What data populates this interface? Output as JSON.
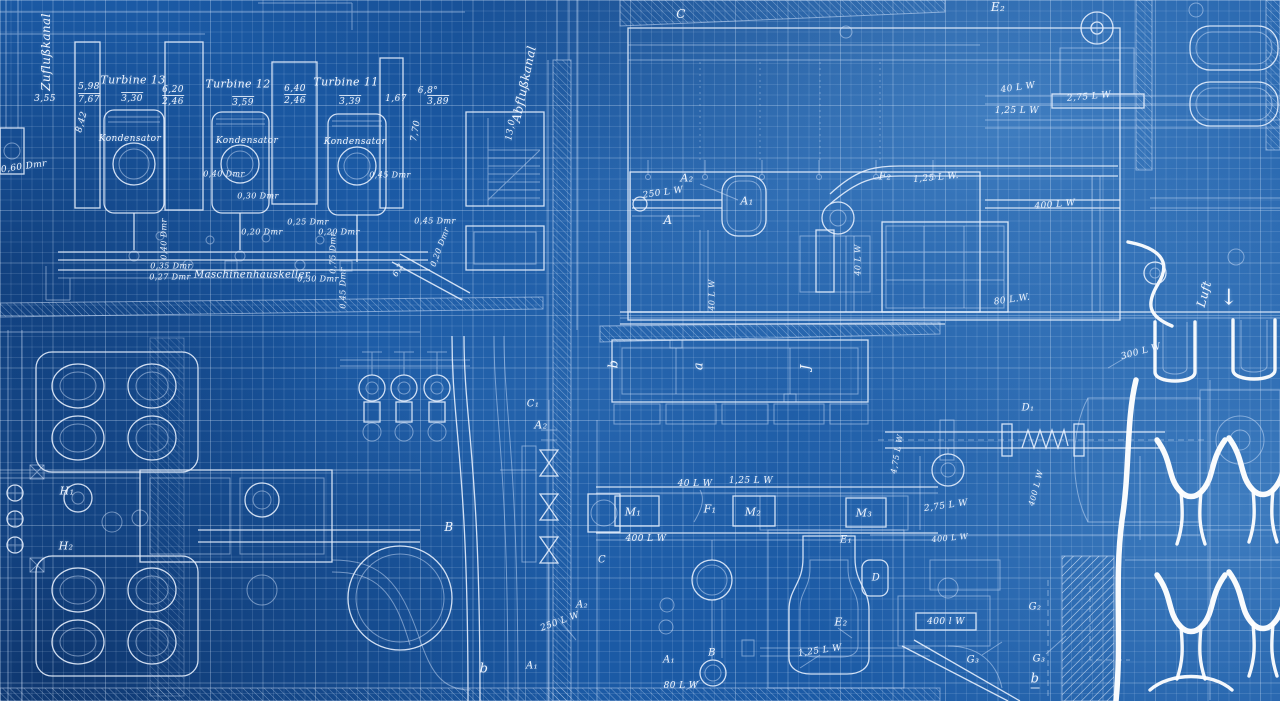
{
  "colors": {
    "paper": "#1b5aa5",
    "line": "#eaf2ff",
    "grid": "rgba(214,232,255,0.15)",
    "bright": "#ffffff"
  },
  "labels": [
    {
      "t": "Zuflußkanal",
      "x": 46,
      "y": 52,
      "r": -90,
      "s": 12
    },
    {
      "t": "Abflußkanal",
      "x": 524,
      "y": 84,
      "r": -78,
      "s": 12
    },
    {
      "t": "3,55",
      "x": 45,
      "y": 99,
      "s": 9
    },
    {
      "t": "5,98",
      "x": 89,
      "y": 87,
      "s": 9
    },
    {
      "t": "7,67",
      "x": 89,
      "y": 99,
      "s": 9,
      "o": 1
    },
    {
      "t": "8,42",
      "x": 82,
      "y": 122,
      "r": -75,
      "s": 9
    },
    {
      "t": "Turbine 13",
      "x": 133,
      "y": 80,
      "s": 11
    },
    {
      "t": "3,30",
      "x": 132,
      "y": 98,
      "s": 9,
      "o": 1
    },
    {
      "t": "Kondensator",
      "x": 130,
      "y": 139,
      "s": 9
    },
    {
      "t": "6,20",
      "x": 173,
      "y": 90,
      "s": 9
    },
    {
      "t": "2,46",
      "x": 173,
      "y": 101,
      "s": 9,
      "o": 1
    },
    {
      "t": "Turbine 12",
      "x": 238,
      "y": 84,
      "s": 11
    },
    {
      "t": "3,59",
      "x": 243,
      "y": 102,
      "s": 9,
      "o": 1
    },
    {
      "t": "Kondensator",
      "x": 247,
      "y": 141,
      "s": 9
    },
    {
      "t": "6,40",
      "x": 295,
      "y": 89,
      "s": 9
    },
    {
      "t": "2,46",
      "x": 295,
      "y": 100,
      "s": 9,
      "o": 1
    },
    {
      "t": "Turbine 11",
      "x": 346,
      "y": 82,
      "s": 11
    },
    {
      "t": "3,39",
      "x": 350,
      "y": 101,
      "s": 9,
      "o": 1
    },
    {
      "t": "Kondensator",
      "x": 355,
      "y": 142,
      "s": 9
    },
    {
      "t": "1,67",
      "x": 396,
      "y": 99,
      "s": 9
    },
    {
      "t": "6,8°",
      "x": 428,
      "y": 91,
      "s": 9
    },
    {
      "t": "3,89",
      "x": 438,
      "y": 101,
      "s": 9,
      "o": 1
    },
    {
      "t": "7,70",
      "x": 416,
      "y": 131,
      "r": -80,
      "s": 9
    },
    {
      "t": "13,0",
      "x": 511,
      "y": 130,
      "r": -80,
      "s": 9
    },
    {
      "t": "0,60 Dmr",
      "x": 24,
      "y": 167,
      "r": -8,
      "s": 9
    },
    {
      "t": "0,40 Dmr",
      "x": 164,
      "y": 239,
      "r": -90,
      "s": 8
    },
    {
      "t": "0,40 Dmr",
      "x": 224,
      "y": 174,
      "s": 8
    },
    {
      "t": "0,45 Dmr",
      "x": 390,
      "y": 175,
      "s": 8
    },
    {
      "t": "0,30 Dmr",
      "x": 258,
      "y": 196,
      "s": 8
    },
    {
      "t": "0,20 Dmr",
      "x": 262,
      "y": 232,
      "s": 8
    },
    {
      "t": "0,25 Dmr",
      "x": 308,
      "y": 222,
      "s": 8
    },
    {
      "t": "0,20 Dmr",
      "x": 339,
      "y": 232,
      "s": 8
    },
    {
      "t": "0,45 Dmr",
      "x": 435,
      "y": 221,
      "s": 8
    },
    {
      "t": "0,20 Dmr",
      "x": 440,
      "y": 247,
      "r": -70,
      "s": 8
    },
    {
      "t": "0,75 Dmr",
      "x": 333,
      "y": 253,
      "r": -90,
      "s": 8
    },
    {
      "t": "0,45 Dmr",
      "x": 343,
      "y": 288,
      "r": -90,
      "s": 8
    },
    {
      "t": "0,35 Dmr",
      "x": 171,
      "y": 266,
      "s": 8
    },
    {
      "t": "0,27 Dmr",
      "x": 170,
      "y": 277,
      "s": 8
    },
    {
      "t": "Maschinenhauskeller",
      "x": 252,
      "y": 275,
      "s": 10
    },
    {
      "t": "0,30 Dmr",
      "x": 318,
      "y": 279,
      "s": 8
    },
    {
      "t": "6,2",
      "x": 398,
      "y": 270,
      "r": -60,
      "s": 8
    },
    {
      "t": "C",
      "x": 681,
      "y": 14,
      "s": 12
    },
    {
      "t": "E₂",
      "x": 998,
      "y": 7,
      "s": 12
    },
    {
      "t": "A₂",
      "x": 687,
      "y": 178,
      "s": 11
    },
    {
      "t": "250 L W",
      "x": 663,
      "y": 193,
      "r": -8,
      "s": 9
    },
    {
      "t": "A",
      "x": 668,
      "y": 220,
      "s": 12
    },
    {
      "t": "A₁",
      "x": 747,
      "y": 201,
      "s": 11
    },
    {
      "t": "F₂",
      "x": 885,
      "y": 176,
      "s": 11
    },
    {
      "t": "1,25 L W.",
      "x": 936,
      "y": 178,
      "r": -5,
      "s": 9
    },
    {
      "t": "40 L W",
      "x": 858,
      "y": 260,
      "r": -90,
      "s": 8
    },
    {
      "t": "40 L W",
      "x": 712,
      "y": 295,
      "r": -90,
      "s": 8
    },
    {
      "t": "40 L W",
      "x": 1018,
      "y": 88,
      "r": -8,
      "s": 9
    },
    {
      "t": "2,75 L W",
      "x": 1089,
      "y": 97,
      "r": -5,
      "s": 9
    },
    {
      "t": "1,25 L W",
      "x": 1017,
      "y": 111,
      "s": 9
    },
    {
      "t": "400 L W",
      "x": 1055,
      "y": 205,
      "r": -5,
      "s": 9
    },
    {
      "t": "80 L.W.",
      "x": 1012,
      "y": 300,
      "r": -8,
      "s": 9
    },
    {
      "t": "Luft",
      "x": 1204,
      "y": 294,
      "r": -75,
      "s": 12
    },
    {
      "t": "↓",
      "x": 1229,
      "y": 298,
      "s": 22,
      "n": "airflow-arrow-icon"
    },
    {
      "t": "300 L W",
      "x": 1141,
      "y": 352,
      "r": -15,
      "s": 9
    },
    {
      "t": "b",
      "x": 614,
      "y": 364,
      "r": -90,
      "s": 13
    },
    {
      "t": "a",
      "x": 699,
      "y": 366,
      "r": -90,
      "s": 13
    },
    {
      "t": "J",
      "x": 806,
      "y": 367,
      "r": -90,
      "s": 13
    },
    {
      "t": "C₁",
      "x": 533,
      "y": 404,
      "s": 10
    },
    {
      "t": "A₂",
      "x": 541,
      "y": 425,
      "s": 11
    },
    {
      "t": "B",
      "x": 449,
      "y": 527,
      "s": 12
    },
    {
      "t": "D₁",
      "x": 1028,
      "y": 408,
      "s": 10
    },
    {
      "t": "4,75 L W",
      "x": 897,
      "y": 454,
      "r": -80,
      "s": 8
    },
    {
      "t": "2,75 L W",
      "x": 946,
      "y": 506,
      "r": -8,
      "s": 9
    },
    {
      "t": "400 L W",
      "x": 1036,
      "y": 488,
      "r": -75,
      "s": 8
    },
    {
      "t": "400 L W",
      "x": 950,
      "y": 538,
      "r": -5,
      "s": 8
    },
    {
      "t": "H₁",
      "x": 67,
      "y": 491,
      "s": 11
    },
    {
      "t": "H₂",
      "x": 66,
      "y": 546,
      "s": 11
    },
    {
      "t": "M₁",
      "x": 633,
      "y": 512,
      "s": 11
    },
    {
      "t": "F₁",
      "x": 710,
      "y": 509,
      "s": 11
    },
    {
      "t": "M₂",
      "x": 753,
      "y": 512,
      "s": 11
    },
    {
      "t": "M₃",
      "x": 864,
      "y": 513,
      "s": 11
    },
    {
      "t": "40 L W",
      "x": 695,
      "y": 484,
      "s": 9
    },
    {
      "t": "1,25 L W",
      "x": 751,
      "y": 481,
      "s": 9
    },
    {
      "t": "400 L W",
      "x": 646,
      "y": 539,
      "s": 9
    },
    {
      "t": "E₁",
      "x": 846,
      "y": 540,
      "s": 10
    },
    {
      "t": "C",
      "x": 602,
      "y": 560,
      "s": 10
    },
    {
      "t": "D",
      "x": 876,
      "y": 578,
      "s": 10
    },
    {
      "t": "A₂",
      "x": 582,
      "y": 605,
      "s": 10
    },
    {
      "t": "250 L W",
      "x": 560,
      "y": 622,
      "r": -20,
      "s": 9
    },
    {
      "t": "A₁",
      "x": 532,
      "y": 666,
      "s": 10
    },
    {
      "t": "b",
      "x": 484,
      "y": 669,
      "s": 13
    },
    {
      "t": "A₁",
      "x": 669,
      "y": 660,
      "s": 10
    },
    {
      "t": "B",
      "x": 712,
      "y": 653,
      "s": 10
    },
    {
      "t": "80 L W",
      "x": 681,
      "y": 686,
      "s": 9
    },
    {
      "t": "E₂",
      "x": 841,
      "y": 622,
      "s": 11
    },
    {
      "t": "1,25 L W",
      "x": 820,
      "y": 651,
      "r": -8,
      "s": 9
    },
    {
      "t": "G₂",
      "x": 1035,
      "y": 607,
      "s": 10
    },
    {
      "t": "400 l W",
      "x": 946,
      "y": 622,
      "s": 9
    },
    {
      "t": "G₃",
      "x": 973,
      "y": 660,
      "s": 10
    },
    {
      "t": "G₃",
      "x": 1039,
      "y": 659,
      "s": 10
    },
    {
      "t": "b",
      "x": 1035,
      "y": 680,
      "s": 13,
      "u": 1
    }
  ]
}
